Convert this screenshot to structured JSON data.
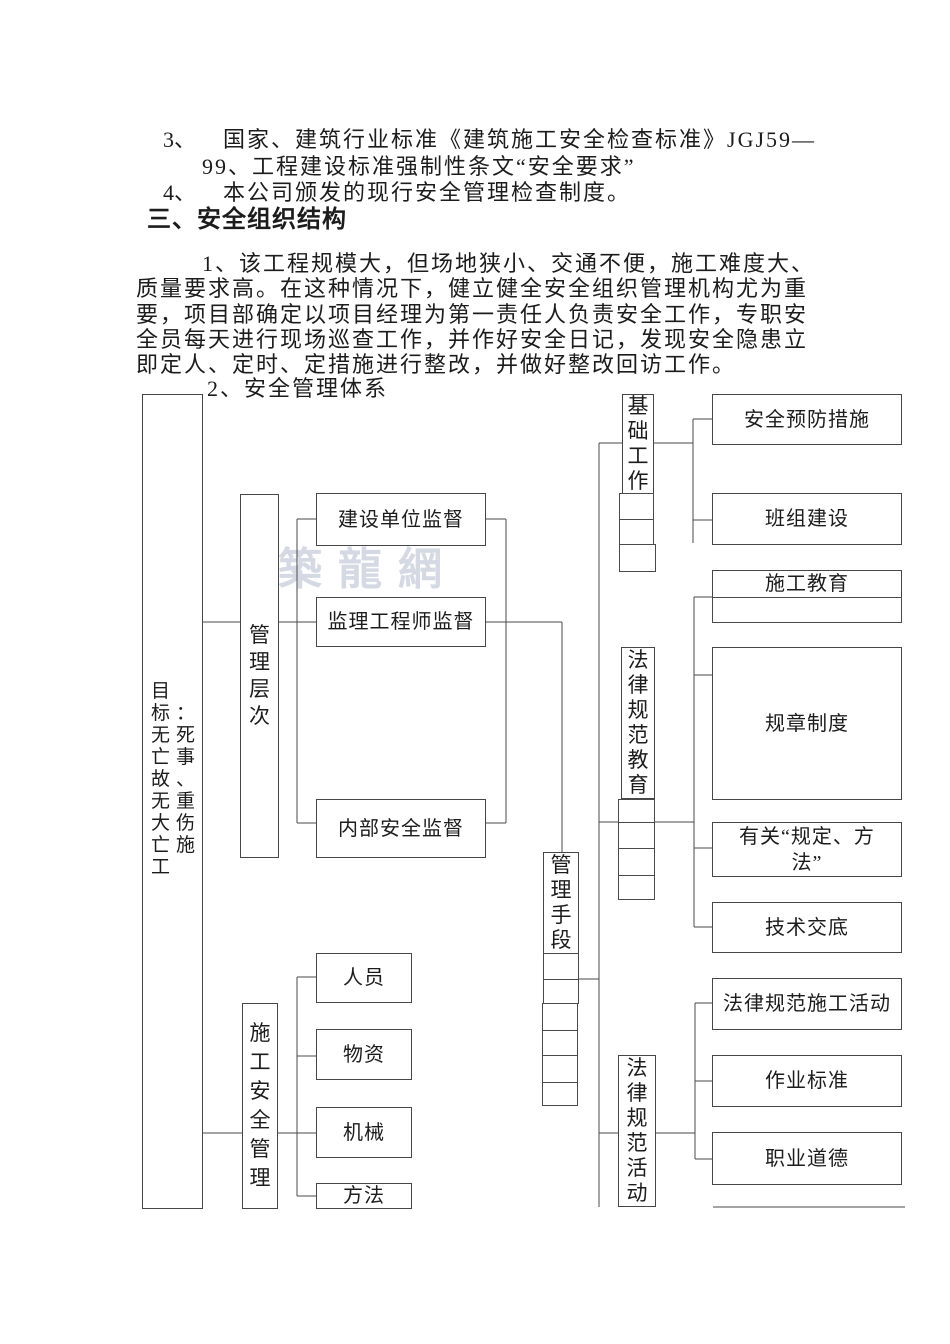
{
  "page": {
    "background": "#ffffff",
    "ink": "#1c1c1c",
    "line_color": "#4a4a4a"
  },
  "text_block": {
    "item3_num": "3、",
    "item3_line1": "国家、建筑行业标准《建筑施工安全检查标准》JGJ59—",
    "item3_line2": "99、工程建设标准强制性条文“安全要求”",
    "item4_num": "4、",
    "item4_text": "本公司颁发的现行安全管理检查制度。",
    "heading": "三、安全组织结构",
    "para_line1": "1、该工程规模大，但场地狭小、交通不便，施工难度大、",
    "para_line2": "质量要求高。在这种情况下，健立健全安全组织管理机构尤为重",
    "para_line3": "要，项目部确定以项目经理为第一责任人负责安全工作，专职安",
    "para_line4": "全员每天进行现场巡查工作，并作好安全日记，发现安全隐患立",
    "para_line5": "即定人、定时、定措施进行整改，并做好整改回访工作。",
    "subheading": "2、安全管理体系"
  },
  "watermark": {
    "text": "築龍網",
    "color": "#c7cdda"
  },
  "diagram": {
    "goal": {
      "label": "目\n标：\n无死\n亡事\n故、\n无重\n大伤\n亡施\n工"
    },
    "management_levels": {
      "label": "管\n理\n层\n次"
    },
    "construction_unit_supervision": {
      "label": "建设单位监督"
    },
    "supervising_engineer_supervision": {
      "label": "监理工程师监督"
    },
    "internal_safety_supervision": {
      "label": "内部安全监督"
    },
    "basic_work": {
      "label": "基\n础\n工\n作"
    },
    "safety_precautions": {
      "label": "安全预防措施"
    },
    "team_building": {
      "label": "班组建设"
    },
    "construction_education": {
      "label": "施工教育"
    },
    "rules_regulations": {
      "label": "规章制度"
    },
    "related_provisions": {
      "label": "有关“规定、方\n法”"
    },
    "technical_disclosure": {
      "label": "技术交底"
    },
    "management_means": {
      "label": "管\n理\n手\n段"
    },
    "legal_norm_education": {
      "label": "法\n律\n规\n范\n教\n育"
    },
    "legal_norm_construction_activity": {
      "label": "法律规范施工活动"
    },
    "work_standards": {
      "label": "作业标准"
    },
    "professional_ethics": {
      "label": "职业道德"
    },
    "legal_norm_activities": {
      "label": "法\n律\n规\n范\n活\n动"
    },
    "construction_safety_management": {
      "label": "施\n工\n安\n全\n管\n理"
    },
    "personnel": {
      "label": "人员"
    },
    "materials": {
      "label": "物资"
    },
    "machinery": {
      "label": "机械"
    },
    "methods": {
      "label": "方法"
    }
  }
}
